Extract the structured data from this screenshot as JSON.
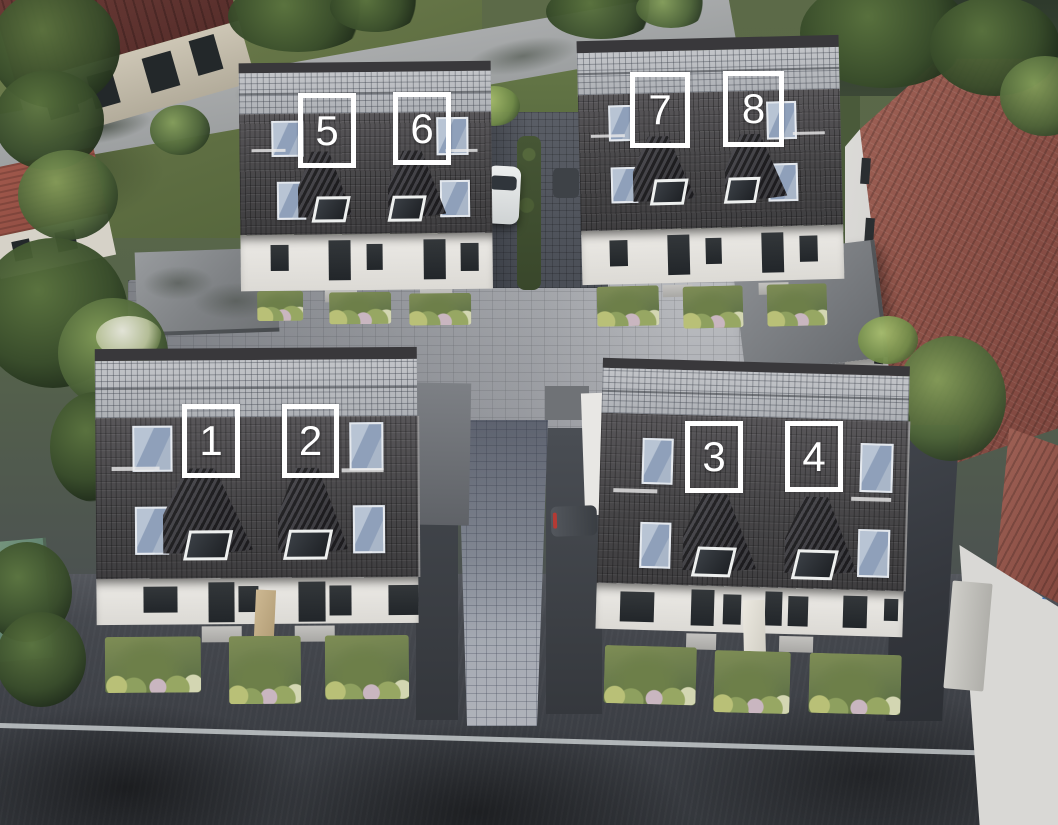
{
  "scene_label": "aerial-rendering-residential-development",
  "units": [
    {
      "number": "1"
    },
    {
      "number": "2"
    },
    {
      "number": "3"
    },
    {
      "number": "4"
    },
    {
      "number": "5"
    },
    {
      "number": "6"
    },
    {
      "number": "7"
    },
    {
      "number": "8"
    }
  ],
  "palette": {
    "label_border": "#ffffff",
    "label_text": "#ffffff",
    "roof_dark": "#4b494c",
    "solar_panel": "#b7b9be",
    "skylight_glass": "#9aa8bf",
    "facade_white": "#eceae6",
    "window_dark": "#2b2e31",
    "garden_green": "#75854f",
    "grass": "#72814f",
    "canopy_green": "#3f5534",
    "cobblestone": "#b6b8bc",
    "asphalt": "#42454b",
    "red_roof": "#96594e",
    "maroon_roof": "#603431",
    "teal_wall": "#6d8f7e",
    "carport_grey": "#888b8f",
    "car_white": "#dcdfdf",
    "car_dark": "#3a3e43",
    "road_marking": "#d8dddf",
    "sign_blue": "#3b72b8"
  }
}
